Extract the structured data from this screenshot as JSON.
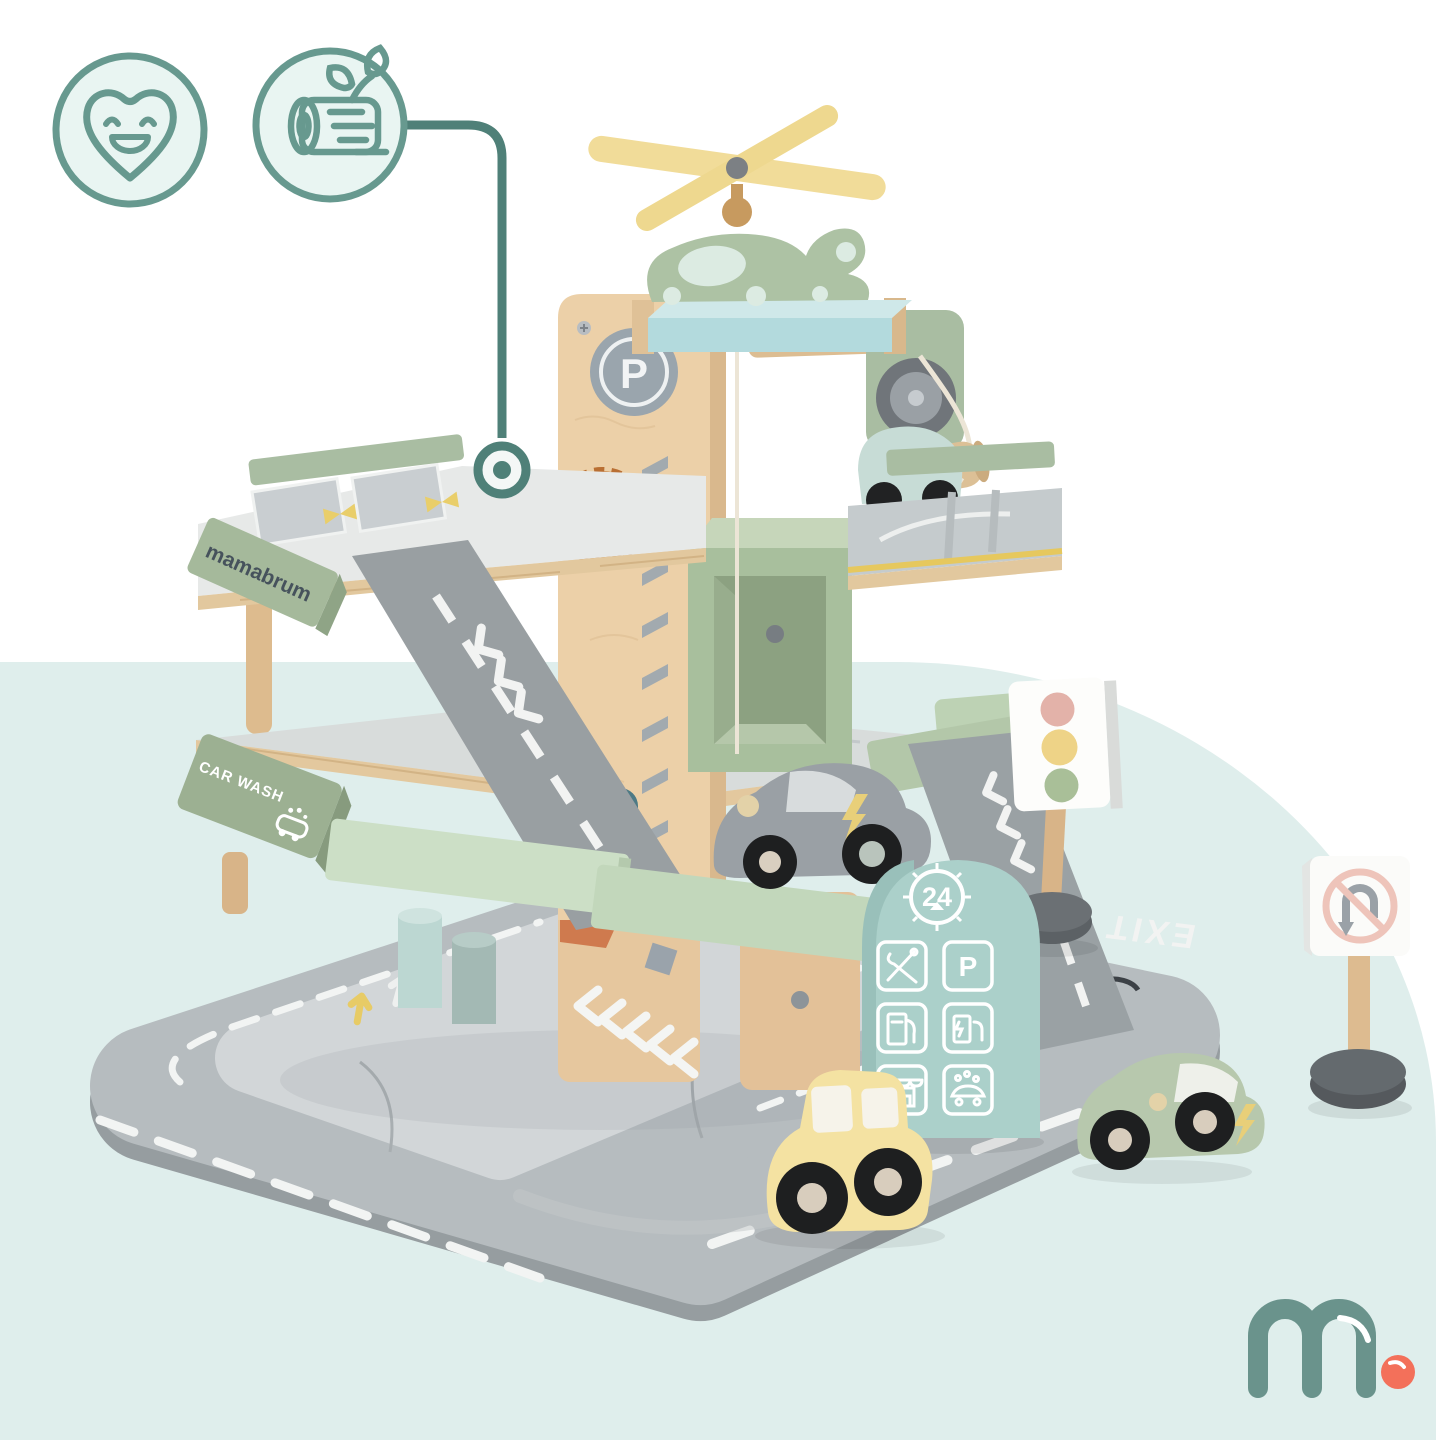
{
  "product": {
    "description": "wooden toy parking garage play set product photo"
  },
  "feature_badges": {
    "items": [
      {
        "icon": "heart-smile-icon",
        "meaning": "kid-friendly"
      },
      {
        "icon": "wood-log-icon",
        "meaning": "natural-wood"
      }
    ]
  },
  "toy": {
    "brand_beam": "mamabrum",
    "car_wash_beam": "CAR WASH",
    "tower_parking_letter": "P",
    "deck_parking_letter_1": "P",
    "deck_parking_letter_2": "P",
    "road_exit": "EXIT",
    "arch_sign": {
      "hours": "24",
      "parking_letter": "P",
      "service_icons": [
        "tools-icon",
        "parking-icon",
        "fuel-pump-icon",
        "ev-charging-icon",
        "shop-icon",
        "car-wash-icon"
      ]
    },
    "vehicles": [
      "helicopter",
      "mint-car",
      "gray-electric-car",
      "yellow-car",
      "green-electric-car"
    ],
    "signs": [
      "traffic-light",
      "no-u-turn-sign"
    ]
  },
  "logo": {
    "text": "m."
  },
  "palette": {
    "background": "#ffffff",
    "blob": "#dfeeec",
    "badge_stroke": "#67998f",
    "badge_fill": "#e9f5f2",
    "callout_line": "#4f8078",
    "wood": "#e9cda4",
    "sage_green": "#a9bda2",
    "mint_beam": "#ccdfc6",
    "arch_mint": "#abd0ca",
    "road_gray": "#9aa1a4",
    "mat_gray": "#b6bcbf",
    "helipad_blue": "#b3dadd",
    "yellow": "#f2dc96",
    "coral_dot": "#f3705a",
    "logo_teal": "#6a938c"
  }
}
